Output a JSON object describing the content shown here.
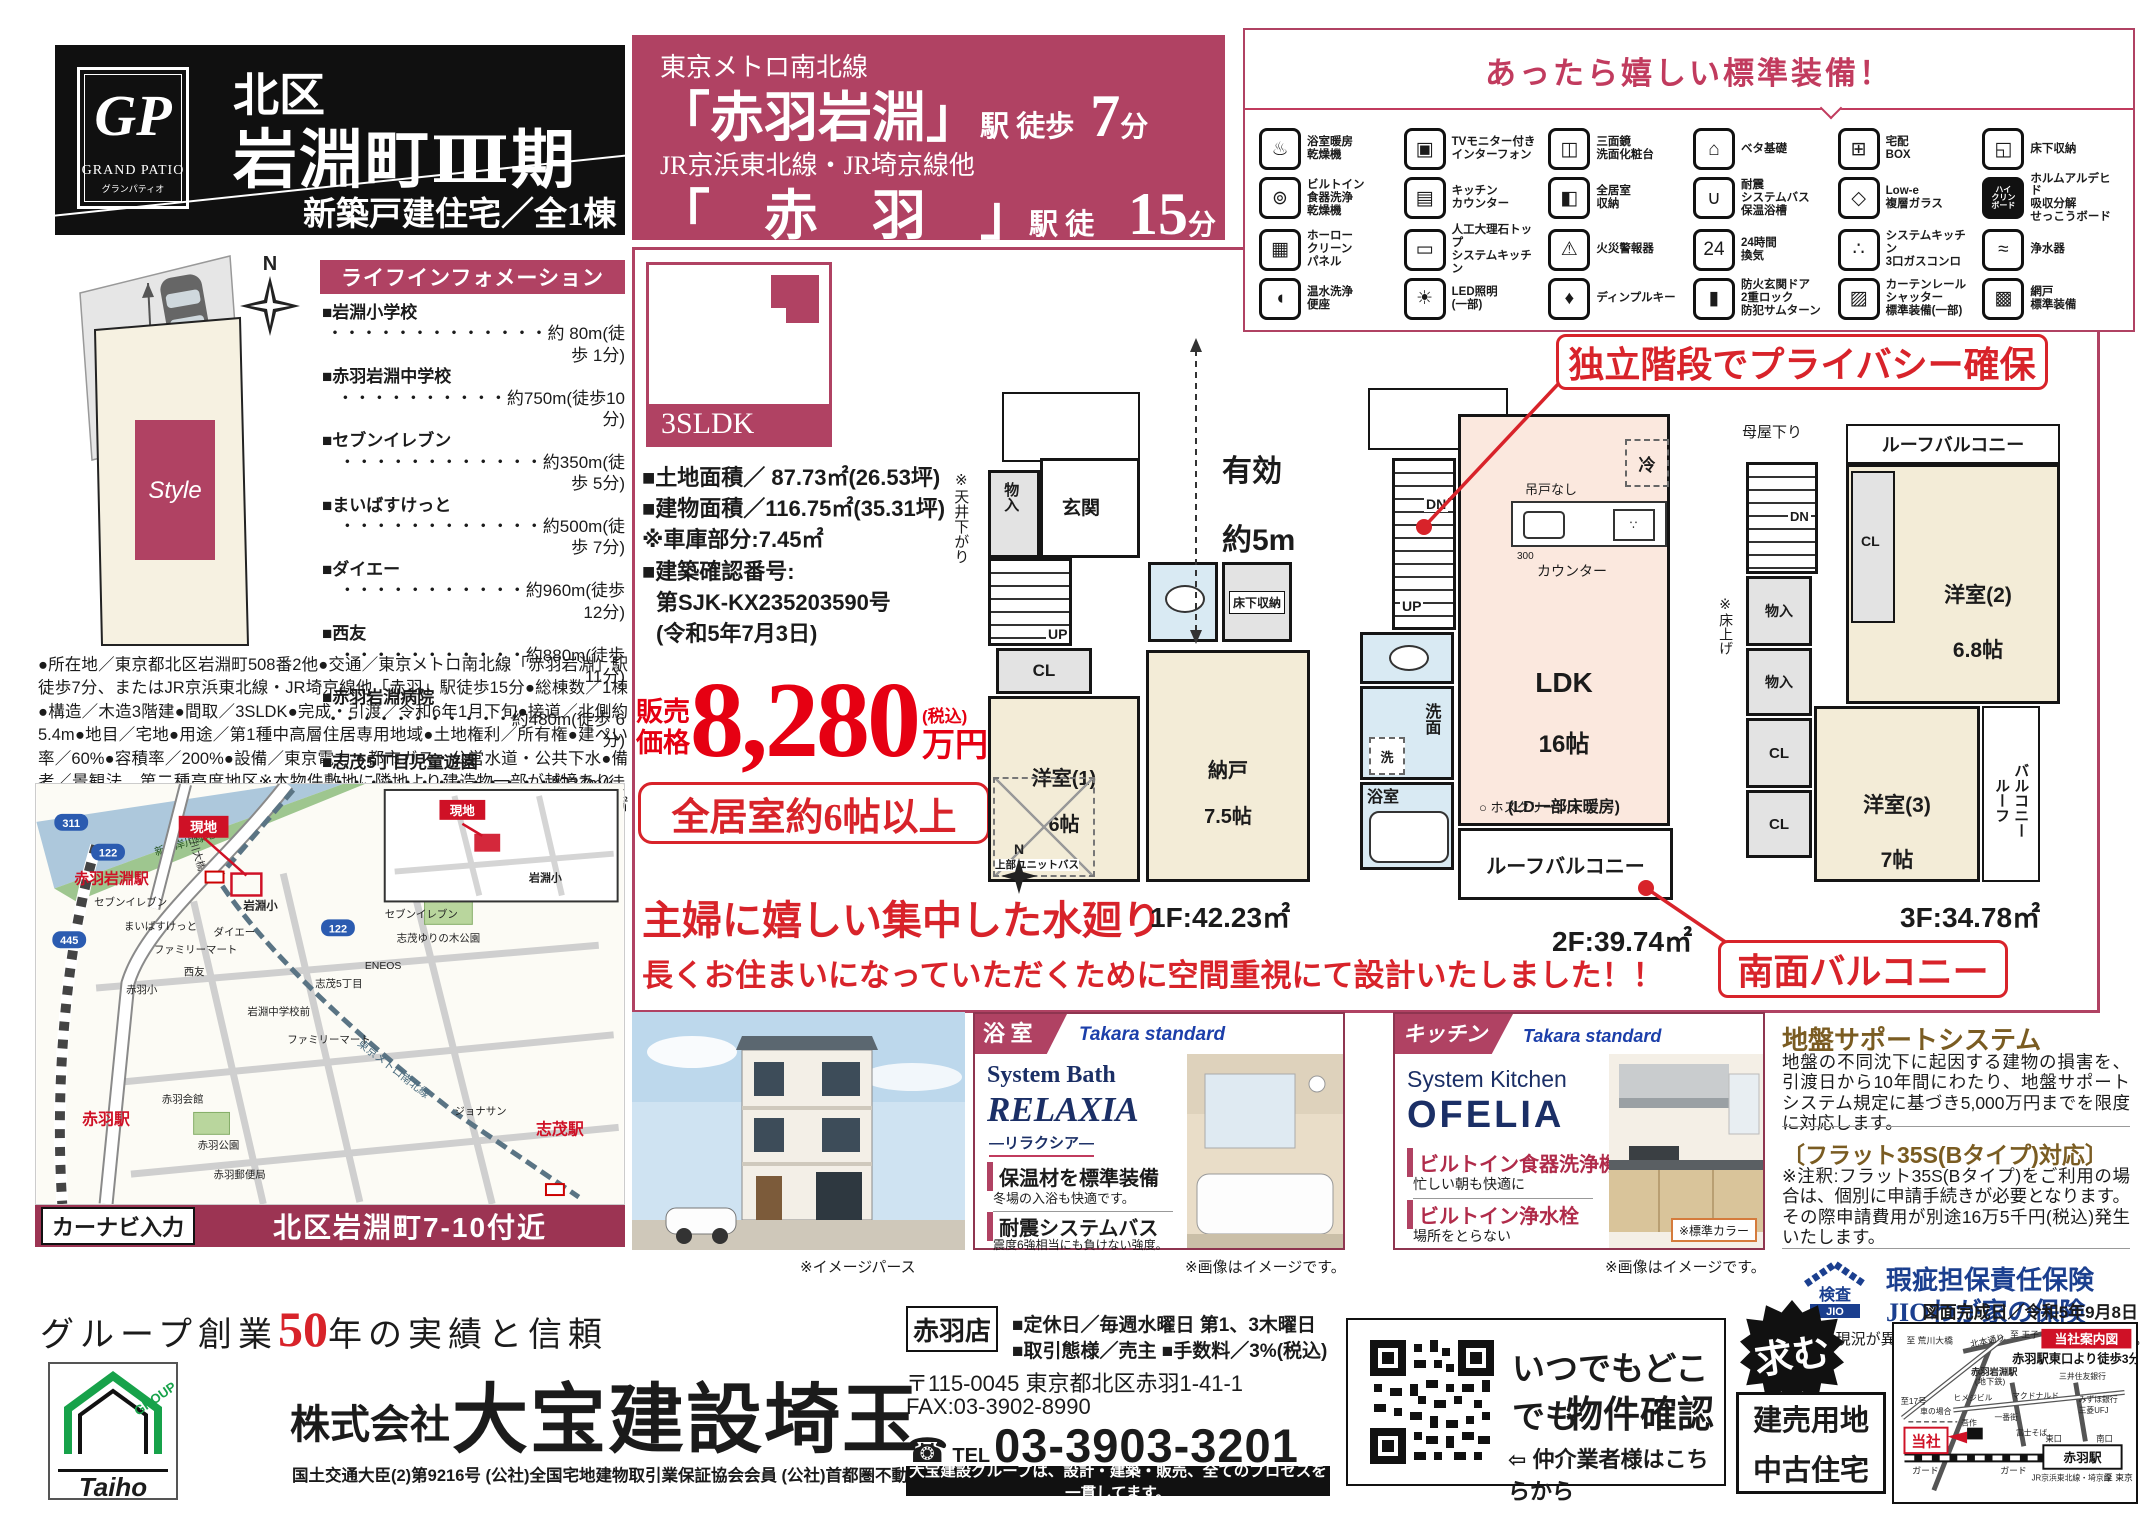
{
  "header": {
    "gp": "GP",
    "brand_en": "GRAND PATIO",
    "brand_kana": "グランパティオ",
    "ward": "北区",
    "town": "岩淵町Ⅲ期",
    "subtitle": "新築戸建住宅／全1棟"
  },
  "access": {
    "rail1": "東京メトロ南北線",
    "station1": "「赤羽岩淵」",
    "walk1": "駅 徒歩",
    "min1": "7",
    "unit1": "分",
    "rail2": "JR京浜東北線・JR埼京線他",
    "station2": "「　赤　羽　」",
    "walk2": "駅 徒歩",
    "min2": "15",
    "unit2": "分"
  },
  "equipment": {
    "title": "あったら嬉しい標準装備！",
    "items": [
      {
        "icon": "♨",
        "label": "浴室暖房\n乾燥機"
      },
      {
        "icon": "▣",
        "label": "TVモニター付き\nインターフォン"
      },
      {
        "icon": "◫",
        "label": "三面鏡\n洗面化粧台"
      },
      {
        "icon": "⌂",
        "label": "ベタ基礎"
      },
      {
        "icon": "⊞",
        "label": "宅配\nBOX"
      },
      {
        "icon": "◱",
        "label": "床下収納"
      },
      {
        "icon": "⊚",
        "label": "ビルトイン\n食器洗浄\n乾燥機"
      },
      {
        "icon": "▤",
        "label": "キッチン\nカウンター"
      },
      {
        "icon": "◧",
        "label": "全居室\n収納"
      },
      {
        "icon": "∪",
        "label": "耐震\nシステムバス\n保温浴槽"
      },
      {
        "icon": "◇",
        "label": "Low-e\n複層ガラス"
      },
      {
        "icon": "ハイ\nクリン\nボード",
        "label": "ホルムアルデヒド\n吸収分解\nせっこうボード"
      },
      {
        "icon": "▦",
        "label": "ホーロー\nクリーン\nパネル"
      },
      {
        "icon": "▭",
        "label": "人工大理石トップ\nシステムキッチン"
      },
      {
        "icon": "⚠",
        "label": "火災警報器"
      },
      {
        "icon": "24",
        "label": "24時間\n換気"
      },
      {
        "icon": "∴",
        "label": "システムキッチン\n3口ガスコンロ"
      },
      {
        "icon": "≈",
        "label": "浄水器"
      },
      {
        "icon": "◖",
        "label": "温水洗浄\n便座"
      },
      {
        "icon": "☀",
        "label": "LED照明\n(一部)"
      },
      {
        "icon": "♦",
        "label": "ディンプルキー"
      },
      {
        "icon": "▮",
        "label": "防火玄関ドア\n2重ロック\n防犯サムターン"
      },
      {
        "icon": "▨",
        "label": "カーテンレール\nシャッター\n標準装備(一部)"
      },
      {
        "icon": "▩",
        "label": "網戸\n標準装備"
      }
    ]
  },
  "site": {
    "road": "約5.4m公道",
    "style": "Style",
    "north": "N"
  },
  "life": {
    "title": "ライフインフォメーション",
    "items": [
      {
        "name": "■岩淵小学校",
        "dist": "・・・・・・・・・・・・・約 80m(徒歩 1分)"
      },
      {
        "name": "■赤羽岩淵中学校",
        "dist": "・・・・・・・・・・約750m(徒歩10分)"
      },
      {
        "name": "■セブンイレブン",
        "dist": "・・・・・・・・・・・・約350m(徒歩 5分)"
      },
      {
        "name": "■まいばすけっと",
        "dist": "・・・・・・・・・・・・約500m(徒歩 7分)"
      },
      {
        "name": "■ダイエー",
        "dist": "・・・・・・・・・・・約960m(徒歩12分)"
      },
      {
        "name": "■西友",
        "dist": "・・・・・・・・・・・約880m(徒歩11分)"
      },
      {
        "name": "■赤羽岩淵病院",
        "dist": "・・・・・・・・・・・約480m(徒歩 6分)"
      },
      {
        "name": "■志茂5丁目児童遊園",
        "dist": "・・・・・・・・・・・・・約27m(徒歩 1分)"
      }
    ]
  },
  "legal": "●所在地／東京都北区岩淵町508番2他●交通／東京メトロ南北線「赤羽岩淵」駅徒歩7分、またはJR京浜東北線・JR埼京線他「赤羽」駅徒歩15分●総棟数／1棟●構造／木造3階建●間取／3SLDK●完成・引渡／令和6年1月下旬●接道／北側約5.4m●地目／宅地●用途／第1種中高層住居専用地域●土地権利／所有権●建ぺい率／60%●容積率／200%●設備／東京電力・都市ガス・公営水道・公共下水●備考／景観法、第二種高度地区※本物件敷地に隣地より建造物一部が越境あり、覚書取得済です。敷地面積(登記)91.62㎡、確認申請上3.89㎡除積、他SB6.95㎡有",
  "offer": {
    "plan_type": "3SLDK",
    "land": "■土地面積／ 87.73㎡(26.53坪)",
    "building": "■建物面積／116.75㎡(35.31坪)",
    "garage": "※車庫部分:7.45㎡",
    "confirm_label": "■建築確認番号:",
    "confirm_no": "第SJK-KX235203590号",
    "confirm_date": "(令和5年7月3日)",
    "price_l1": "販売",
    "price_l2": "価格",
    "price": "8,280",
    "tax": "(税込)",
    "unit": "万円",
    "rooms_badge": "全居室約6帖以上"
  },
  "catch": {
    "l1": "主婦に嬉しい集中した水廻り",
    "l2": "長くお住まいになっていただくために空間重視にて設計いたしました！！"
  },
  "plans": {
    "privacy": "独立階段でプライバシー確保",
    "south": "南面バルコニー",
    "eff1": "有効",
    "eff2": "約5m",
    "ceiling": "※天井下がり",
    "f1": {
      "area": "1F:42.23㎡",
      "genkan": "玄関",
      "mono": "物入",
      "up": "UP",
      "cl": "CL",
      "yuka": "床下収納",
      "r1a": "洋室(1)",
      "r1b": "6帖",
      "ub": "上部ユニットバス",
      "na": "納戸",
      "nb": "7.5帖",
      "n": "N"
    },
    "f2": {
      "area": "2F:39.74㎡",
      "dn": "DN",
      "up": "UP",
      "sen": "洗",
      "senmen": "洗面",
      "bath": "浴室",
      "rei": "冷",
      "tsuri": "吊戸なし",
      "dim": "300",
      "counter": "カウンター",
      "la": "LDK",
      "lb": "16帖",
      "lc": "(LD一部床暖房)",
      "hos": "ホスクリーン",
      "rb": "ルーフバルコニー"
    },
    "f3": {
      "area": "3F:34.78㎡",
      "dn": "DN",
      "moya": "母屋下り",
      "yuka": "※床上げ",
      "m1": "物入",
      "m2": "物入",
      "c1": "CL",
      "c2": "CL",
      "c3": "CL",
      "r2a": "洋室(2)",
      "r2b": "6.8帖",
      "r3a": "洋室(3)",
      "r3b": "7帖",
      "rb": "ルーフバルコニー",
      "bv1": "ルーフ",
      "bv2": "バルコニー"
    }
  },
  "captions": {
    "render": "※イメージパース",
    "bath": "※画像はイメージです。",
    "kitchen": "※画像はイメージです。",
    "color": "※標準カラー"
  },
  "bath": {
    "tag": "浴 室",
    "brand": "Takara standard",
    "series": "System Bath",
    "name": "RELAXIA",
    "kana": "―リラクシア―",
    "f1": "保温材を標準装備",
    "f1d": "冬場の入浴も快適です。",
    "f2": "耐震システムバス",
    "f2d": "震度6強相当にも負けない強度。"
  },
  "kitchen": {
    "tag": "キッチン",
    "brand": "Takara standard",
    "series": "System Kitchen",
    "name": "OFELIA",
    "f1": "ビルトイン食器洗浄機",
    "f1d": "忙しい朝も快適に",
    "f2": "ビルトイン浄水栓",
    "f2d": "場所をとらない"
  },
  "support": {
    "title": "地盤サポートシステム",
    "body": "地盤の不同沈下に起因する建物の損害を、引渡日から10年間にわたり、地盤サポートシステム規定に基づき5,000万円までを限度に対応します。",
    "flat_title": "〔フラット35S(Bタイプ)対応〕",
    "flat_body": "※注釈:フラット35S(Bタイプ)をご利用の場合は、個別に申請手続きが必要となります。その際申請費用が別途16万5千円(税込)発生いたします。",
    "jio_kensa": "検査",
    "jio": "JIO",
    "jio_line1": "瑕疵担保責任保険",
    "jio_line2": "JIOわが家の保険",
    "note": "※図面と現況が異なる場合は現況を優先といたします。",
    "date": "図面完成日／令和5年9月8日"
  },
  "map": {
    "navi": "カーナビ入力",
    "addr": "北区岩淵町7-10付近",
    "labels": [
      "新河岸川緑地",
      "新荒川大橋",
      "現地",
      "岩淵小",
      "セブンイレブン",
      "まいばすけっと",
      "ファミリーマート",
      "西友",
      "ダイエー",
      "赤羽岩淵駅",
      "岩淵中学校前",
      "ファミリーマート",
      "志茂5丁目",
      "ENEOS",
      "セブンイレブン",
      "志茂ゆりの木公園",
      "ジョナサン",
      "赤羽会館",
      "赤羽公園",
      "赤羽郵便局",
      "赤羽駅",
      "志茂駅",
      "東京メトロ南北線",
      "現地",
      "岩淵小",
      "311",
      "122",
      "445",
      "122",
      "赤羽小"
    ]
  },
  "footer": {
    "slogan_pre": "グループ創業",
    "slogan_num": "50",
    "slogan_post": "年の実績と信頼",
    "logo_taiho": "Taiho",
    "logo_group": "GROUP",
    "company_prefix": "株式会社",
    "company": "大宝建設埼玉",
    "license": "国土交通大臣(2)第9216号 (公社)全国宅地建物取引業保証協会会員 (公社)首都圏不動産公正取引協議会加盟",
    "shop": "赤羽店",
    "holiday": "■定休日／毎週水曜日 第1、3木曜日",
    "terms": "■取引態様／売主 ■手数料／3%(税込)",
    "address": "〒115-0045 東京都北区赤羽1-41-1",
    "fax": "FAX:03-3902-8990",
    "tel_label": "TEL",
    "tel": "03-3903-3201",
    "bar": "大宝建設グループは、設計・建築・販売、全てのプロセスを一貫してます。",
    "qr1": "いつでもどこでも",
    "qr2": "物件確認",
    "qr3": "⇦ 仲介業者様はこちらから",
    "motomu": "求む",
    "lots1": "建売用地",
    "lots2": "中古住宅"
  },
  "cmap": {
    "title": "当社案内図",
    "walk": "赤羽駅東口より徒歩3分",
    "spots": [
      "至 荒川大橋",
      "北本通り",
      "至 王子",
      "赤羽岩淵駅",
      "(地下鉄)",
      "三井住友銀行",
      "みずほ銀行",
      "三菱UFJ",
      "マクドナルド",
      "ヒメジビル",
      "一番街",
      "吾作",
      "富士そば",
      "車の場合",
      "当社",
      "ガード",
      "ガード",
      "東口",
      "南口",
      "赤羽駅",
      "至 東京",
      "至17号",
      "JR京浜東北線・埼京線"
    ]
  }
}
